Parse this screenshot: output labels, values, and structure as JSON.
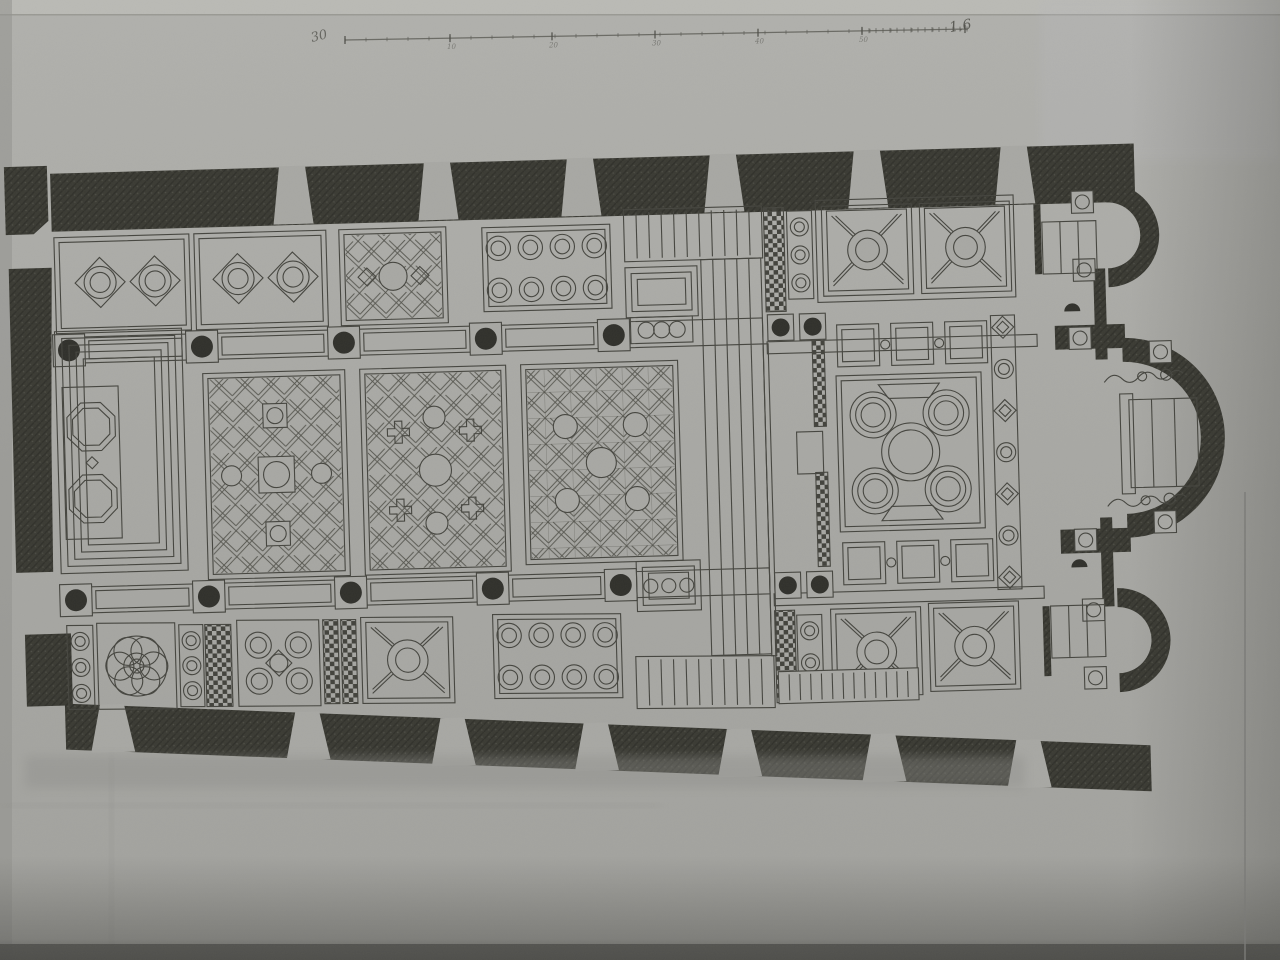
{
  "meta": {
    "description": "Photographed engraved plate: floor plan of a basilica with ornamental cosmatesque pavement, three apses at right, nave panels, aisles and scale bar"
  },
  "photo": {
    "paper_light": "#b3b3af",
    "paper": "#a9a9a5",
    "paper_dark": "#9b9b97",
    "wall_dark": "#3a3a33",
    "ink": "#45453f",
    "bottom_edge": "#4e4e4a",
    "top_strip": "#bcbcb8"
  },
  "scale_bar": {
    "x1": 345,
    "y1": 40,
    "x2": 968,
    "y2": 29,
    "major_xs": [
      345,
      450,
      552,
      655,
      758,
      862,
      965
    ],
    "tick_labels": [
      {
        "x": 450,
        "t": "10"
      },
      {
        "x": 552,
        "t": "20"
      },
      {
        "x": 655,
        "t": "30"
      },
      {
        "x": 758,
        "t": "40"
      },
      {
        "x": 862,
        "t": "50"
      }
    ],
    "minor_step": 21,
    "dense_from": 862,
    "dense_step": 7,
    "left_annotation": "30",
    "end_label": "1.6"
  },
  "plan": {
    "rotation": "rotate(-1.6 620 450)",
    "walls": [
      {
        "n": "north-wall-band",
        "pts": [
          [
            58,
            158
          ],
          [
            1142,
            158
          ],
          [
            1142,
            216
          ],
          [
            58,
            216
          ]
        ]
      },
      {
        "n": "south-wall-band",
        "pts": [
          [
            58,
            688
          ],
          [
            1142,
            760
          ],
          [
            1142,
            806
          ],
          [
            58,
            734
          ]
        ]
      },
      {
        "n": "west-wall-corner-nw",
        "pts": [
          [
            12,
            150
          ],
          [
            55,
            150
          ],
          [
            55,
            205
          ],
          [
            40,
            218
          ],
          [
            12,
            218
          ]
        ]
      },
      {
        "n": "west-wall-main",
        "pts": [
          [
            14,
            252
          ],
          [
            57,
            252
          ],
          [
            52,
            420
          ],
          [
            50,
            556
          ],
          [
            13,
            556
          ]
        ]
      },
      {
        "n": "west-wall-corner-sw",
        "pts": [
          [
            20,
            618
          ],
          [
            66,
            618
          ],
          [
            66,
            690
          ],
          [
            20,
            690
          ]
        ]
      }
    ],
    "piers_top": [
      [
        [
          287,
          157
        ],
        [
          313,
          157
        ],
        [
          320,
          215
        ],
        [
          280,
          215
        ]
      ],
      [
        [
          432,
          157
        ],
        [
          458,
          157
        ],
        [
          465,
          215
        ],
        [
          425,
          215
        ]
      ],
      [
        [
          575,
          157
        ],
        [
          601,
          157
        ],
        [
          608,
          215
        ],
        [
          568,
          215
        ]
      ],
      [
        [
          718,
          157
        ],
        [
          744,
          157
        ],
        [
          751,
          215
        ],
        [
          711,
          215
        ]
      ],
      [
        [
          862,
          157
        ],
        [
          888,
          157
        ],
        [
          895,
          215
        ],
        [
          855,
          215
        ]
      ],
      [
        [
          1009,
          157
        ],
        [
          1035,
          157
        ],
        [
          1042,
          215
        ],
        [
          1002,
          215
        ]
      ]
    ],
    "piers_bottom": [
      [
        [
          93,
          690
        ],
        [
          117,
          690
        ],
        [
          127,
          738
        ],
        [
          83,
          738
        ]
      ],
      [
        [
          288,
          703
        ],
        [
          312,
          703
        ],
        [
          322,
          751
        ],
        [
          278,
          751
        ]
      ],
      [
        [
          433,
          713
        ],
        [
          457,
          713
        ],
        [
          467,
          761
        ],
        [
          423,
          761
        ]
      ],
      [
        [
          576,
          722
        ],
        [
          600,
          722
        ],
        [
          610,
          770
        ],
        [
          566,
          770
        ]
      ],
      [
        [
          719,
          732
        ],
        [
          743,
          732
        ],
        [
          753,
          780
        ],
        [
          709,
          780
        ]
      ],
      [
        [
          863,
          741
        ],
        [
          887,
          741
        ],
        [
          897,
          789
        ],
        [
          853,
          789
        ]
      ],
      [
        [
          1008,
          751
        ],
        [
          1032,
          751
        ],
        [
          1042,
          799
        ],
        [
          998,
          799
        ]
      ]
    ],
    "apses": [
      {
        "n": "north-side-apse",
        "cx": 1113,
        "cy": 249,
        "ro": 52,
        "ri": 33
      },
      {
        "n": "main-apse",
        "cx": 1125,
        "cy": 452,
        "ro": 100,
        "ri": 76
      },
      {
        "n": "south-side-apse",
        "cx": 1113,
        "cy": 654,
        "ro": 52,
        "ri": 33
      }
    ],
    "east_wall_segments": [
      [
        1098,
        282,
        12,
        91
      ],
      [
        1098,
        531,
        12,
        89
      ]
    ],
    "apse_stubs": [
      [
        1058,
        338,
        70,
        24
      ],
      [
        1058,
        542,
        70,
        24
      ]
    ],
    "chapel_dividers": [
      [
        1040,
        216,
        7,
        70
      ],
      [
        1038,
        618,
        7,
        70
      ]
    ],
    "colonnades": [
      {
        "n": "north-colonnade",
        "x1": 58,
        "x2": 766,
        "y": 322,
        "h": 26,
        "plinths": [
          72,
          205,
          347,
          489,
          617
        ]
      },
      {
        "n": "south-colonnade",
        "x1": 58,
        "x2": 766,
        "y": 572,
        "h": 26,
        "plinths": [
          72,
          205,
          347,
          489,
          617
        ]
      }
    ],
    "panels": [
      {
        "n": "west-carpet-concentric",
        "m": "concentric",
        "x": 58,
        "y": 316,
        "w": 127,
        "h": 242,
        "oct": {
          "x": 64,
          "y": 372,
          "w": 56,
          "h": 152
        }
      },
      {
        "n": "north-aisle-interlace-1",
        "m": "cusped",
        "x": 60,
        "y": 222,
        "w": 135,
        "h": 96,
        "units": [
          [
            105,
            268
          ],
          [
            160,
            268
          ]
        ]
      },
      {
        "n": "north-aisle-interlace-2",
        "m": "cusped",
        "x": 200,
        "y": 222,
        "w": 132,
        "h": 96,
        "units": [
          [
            243,
            268
          ],
          [
            298,
            268
          ]
        ]
      },
      {
        "n": "north-aisle-lattice",
        "m": "lattice",
        "x": 345,
        "y": 222,
        "w": 107,
        "h": 96,
        "acc": [
          [
            "c",
            398,
            270,
            14
          ],
          [
            "d",
            372,
            270,
            9
          ],
          [
            "d",
            425,
            270,
            9
          ]
        ]
      },
      {
        "n": "north-aisle-circle-grid",
        "m": "circgrid",
        "x": 488,
        "y": 224,
        "w": 128,
        "h": 84,
        "cols": 4,
        "rows": 2
      },
      {
        "n": "crossing-north-steps",
        "m": "stripes",
        "x": 630,
        "y": 210,
        "w": 138,
        "h": 52,
        "nl": 10
      },
      {
        "n": "crossing-north-ambo",
        "m": "framed",
        "x": 630,
        "y": 268,
        "w": 72,
        "h": 50
      },
      {
        "n": "crossing-north-circle-band",
        "m": "circrow",
        "x": 634,
        "y": 318,
        "w": 62,
        "h": 26,
        "nc": 3
      },
      {
        "n": "solea-walkway",
        "m": "rails",
        "x": 706,
        "y": 262,
        "w": 60,
        "h": 396,
        "nl": 4
      },
      {
        "n": "crossing-south-circle-band",
        "m": "framed",
        "x": 633,
        "y": 562,
        "w": 64,
        "h": 50,
        "circles": true
      },
      {
        "n": "nave-panel-1",
        "m": "lattice",
        "x": 205,
        "y": 362,
        "w": 142,
        "h": 206,
        "acc": [
          [
            "r",
            258,
            447,
            36,
            36
          ],
          [
            "c",
            276,
            465,
            13
          ],
          [
            "r",
            264,
            394,
            24,
            24
          ],
          [
            "c",
            276,
            406,
            8
          ],
          [
            "r",
            264,
            512,
            24,
            24
          ],
          [
            "c",
            276,
            524,
            8
          ],
          [
            "c",
            231,
            465,
            10
          ],
          [
            "c",
            321,
            465,
            10
          ]
        ]
      },
      {
        "n": "nave-panel-2",
        "m": "lattice",
        "x": 362,
        "y": 362,
        "w": 146,
        "h": 206,
        "acc": [
          [
            "c",
            435,
            465,
            16
          ],
          [
            "c",
            435,
            412,
            11
          ],
          [
            "c",
            435,
            518,
            11
          ],
          [
            "p",
            399,
            426,
            22
          ],
          [
            "p",
            471,
            426,
            22
          ],
          [
            "p",
            399,
            504,
            22
          ],
          [
            "p",
            471,
            504,
            22
          ]
        ]
      },
      {
        "n": "nave-panel-3",
        "m": "lattice",
        "x": 523,
        "y": 362,
        "w": 157,
        "h": 200,
        "grid": true,
        "acc": [
          [
            "c",
            601,
            462,
            15
          ],
          [
            "c",
            566,
            425,
            12
          ],
          [
            "c",
            636,
            425,
            12
          ],
          [
            "c",
            566,
            499,
            12
          ],
          [
            "c",
            636,
            499,
            12
          ]
        ]
      },
      {
        "n": "sanctuary-north-checker",
        "m": "checker",
        "x": 770,
        "y": 212,
        "w": 20,
        "h": 104
      },
      {
        "n": "sanctuary-north-circle-strip",
        "m": "circstrip",
        "x": 793,
        "y": 216,
        "w": 25,
        "h": 88,
        "nc": 3
      },
      {
        "n": "sanctuary-north-panel-frame",
        "m": "plain",
        "x": 822,
        "y": 206,
        "w": 198,
        "h": 102
      },
      {
        "n": "sanctuary-north-x-panel-1",
        "m": "xpanel",
        "x": 828,
        "y": 212,
        "w": 90,
        "h": 90
      },
      {
        "n": "sanctuary-north-x-panel-2",
        "m": "xpanel",
        "x": 926,
        "y": 212,
        "w": 90,
        "h": 90
      },
      {
        "n": "sanctuary-north-step",
        "m": "plain",
        "x": 770,
        "y": 346,
        "w": 270,
        "h": 12
      },
      {
        "n": "sanctuary-squares-row-top",
        "m": "sqrow",
        "x": 840,
        "y": 330,
        "w": 150,
        "h": 44
      },
      {
        "n": "sanctuary-quincunx",
        "m": "quinc5",
        "x": 838,
        "y": 382,
        "w": 145,
        "h": 156
      },
      {
        "n": "sanctuary-squares-row-bottom",
        "m": "sqrow",
        "x": 840,
        "y": 548,
        "w": 150,
        "h": 44
      },
      {
        "n": "sanctuary-guilloche-band",
        "m": "guil",
        "x": 994,
        "y": 326,
        "w": 24,
        "h": 274
      },
      {
        "n": "sanctuary-south-step",
        "m": "plain",
        "x": 770,
        "y": 598,
        "w": 270,
        "h": 12
      },
      {
        "n": "sanctuary-rail-hatch-1",
        "m": "checker",
        "x": 815,
        "y": 338,
        "w": 12,
        "h": 94
      },
      {
        "n": "sanctuary-rail-hatch-2",
        "m": "checker",
        "x": 815,
        "y": 478,
        "w": 12,
        "h": 94
      },
      {
        "n": "sanctuary-rail-box",
        "m": "plain",
        "x": 797,
        "y": 437,
        "w": 26,
        "h": 42
      },
      {
        "n": "sanctuary-south-checker",
        "m": "checker",
        "x": 770,
        "y": 615,
        "w": 20,
        "h": 92
      },
      {
        "n": "sanctuary-south-circle-strip",
        "m": "circstrip",
        "x": 792,
        "y": 620,
        "w": 25,
        "h": 64,
        "nc": 2
      },
      {
        "n": "sanctuary-south-x-panel-1",
        "m": "xpanel",
        "x": 826,
        "y": 615,
        "w": 90,
        "h": 88
      },
      {
        "n": "sanctuary-south-x-panel-2",
        "m": "xpanel",
        "x": 924,
        "y": 612,
        "w": 90,
        "h": 88
      },
      {
        "n": "sanctuary-south-steps",
        "m": "stripes",
        "x": 772,
        "y": 676,
        "w": 140,
        "h": 32,
        "nl": 12,
        "fill": true
      }
    ],
    "panels_bottom": [
      {
        "n": "south-aisle-circle-strip-1",
        "m": "circstrip",
        "x": 62,
        "y": 610,
        "w": 26,
        "h": 84,
        "nc": 3
      },
      {
        "n": "south-aisle-rosette",
        "m": "rosette",
        "x": 92,
        "y": 608,
        "w": 78,
        "h": 86
      },
      {
        "n": "south-aisle-circle-strip-2",
        "m": "circstrip",
        "x": 174,
        "y": 610,
        "w": 24,
        "h": 82,
        "nc": 3
      },
      {
        "n": "south-aisle-checker-1",
        "m": "checker",
        "x": 200,
        "y": 610,
        "w": 26,
        "h": 82
      },
      {
        "n": "south-aisle-quincunx",
        "m": "quinc4",
        "x": 232,
        "y": 606,
        "w": 82,
        "h": 86
      },
      {
        "n": "south-aisle-checker-2",
        "m": "checker",
        "x": 318,
        "y": 606,
        "w": 15,
        "h": 84
      },
      {
        "n": "south-aisle-checker-3",
        "m": "checker",
        "x": 336,
        "y": 606,
        "w": 15,
        "h": 84
      },
      {
        "n": "south-aisle-x-panel",
        "m": "xpanel",
        "x": 356,
        "y": 604,
        "w": 92,
        "h": 86
      },
      {
        "n": "south-aisle-circle-grid",
        "m": "circgrid",
        "x": 488,
        "y": 602,
        "w": 128,
        "h": 84,
        "cols": 4,
        "rows": 2
      },
      {
        "n": "crossing-south-steps",
        "m": "stripes",
        "x": 630,
        "y": 645,
        "w": 138,
        "h": 52,
        "nl": 10,
        "fill": true
      }
    ],
    "sanctuary_plinths": [
      [
        784,
        332
      ],
      [
        816,
        332
      ],
      [
        784,
        590
      ],
      [
        816,
        590
      ]
    ],
    "open_plinths": [
      [
        1089,
        215
      ],
      [
        1089,
        283
      ],
      [
        1083,
        351
      ],
      [
        1083,
        553
      ],
      [
        1163,
        367
      ],
      [
        1163,
        537
      ],
      [
        1089,
        623
      ],
      [
        1089,
        691
      ]
    ],
    "half_columns": [
      [
        1076,
        324
      ],
      [
        1076,
        580
      ]
    ],
    "altars": [
      {
        "n": "north-chapel-altar",
        "x": 1048,
        "y": 234,
        "w": 54,
        "h": 52,
        "l": 2
      },
      {
        "n": "main-altar",
        "x": 1130,
        "y": 414,
        "w": 68,
        "h": 88,
        "l": 2,
        "flange": true
      },
      {
        "n": "south-chapel-altar",
        "x": 1046,
        "y": 618,
        "w": 54,
        "h": 52,
        "l": 2
      }
    ],
    "scrolls": [
      [
        1106,
        388
      ],
      [
        1106,
        512
      ]
    ],
    "rail_line": [
      766,
      348,
      5,
      312
    ]
  }
}
